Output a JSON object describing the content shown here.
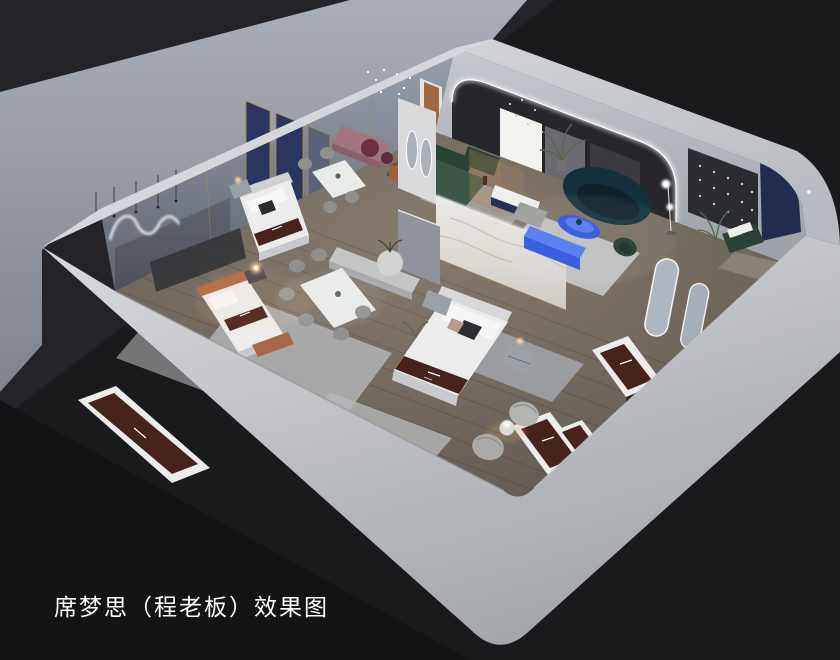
{
  "caption": {
    "text": "席梦思（程老板）效果图"
  },
  "scene": {
    "kind": "3d-isometric-interior-render",
    "subject": "cutaway rendering of a mattress showroom with bedrooms, dining sets and lounge",
    "objects": [
      "bed",
      "mattress-display",
      "dining-set",
      "green-sectional-sofa",
      "teal-curved-sofa",
      "blue-coffee-table",
      "blue-console",
      "marble-partition",
      "arched-led-portal",
      "arched-floor-mirrors",
      "teddy-lounge-chairs",
      "chandelier",
      "neon-squiggle-light",
      "string-lights",
      "rug",
      "nightstand",
      "floor-lamp",
      "plant"
    ]
  },
  "palette": {
    "bg": "#1a1a1d",
    "bgTopLeft": "#232328",
    "bgBottom": "#141416",
    "ground": "#9a9ea6",
    "band": "#c7c9cd",
    "wallLeft": "#8b93a1",
    "wallRight": "#b3b7bd",
    "archDark": "#26262b",
    "ledGlow": "#ffffff",
    "navy": "#232c4e",
    "navyScreen": "#2c3560",
    "goldTrim": "#a8854f",
    "floor": "#756c63",
    "rug": "#bcbec1",
    "rugCool": "#9aa1ab",
    "marble": "#e3e2df",
    "marbleVein": "#b9a88c",
    "mattress": "#ececed",
    "mattressSide": "#c9cacd",
    "runner": "#46231d",
    "pillowDark": "#2c2c31",
    "pillowTan": "#b39c8b",
    "headboardRust": "#b26a46",
    "lampWarm": "#ffd9a2",
    "sofaGreen": "#3c5747",
    "sofaGreenDark": "#2c4236",
    "sofaTeal": "#14313b",
    "sofaTealDark": "#0d2129",
    "cobalt": "#2f55e0",
    "cobaltLight": "#5377f0",
    "mauve": "#a3737e",
    "burgundy": "#6b3140",
    "rust": "#a65d3d",
    "chairGray": "#90918f",
    "tableWhite": "#e9eaea",
    "teddy": "#aaaaa7",
    "nightstand": "#9aa0a6",
    "benchLight": "#c4c5c7",
    "darkPanel": "#2b2c31",
    "stringLight": "#e8c79a",
    "wood": "#9b6a3f",
    "plantGreen": "#55684e",
    "caption": "#ffffff"
  }
}
